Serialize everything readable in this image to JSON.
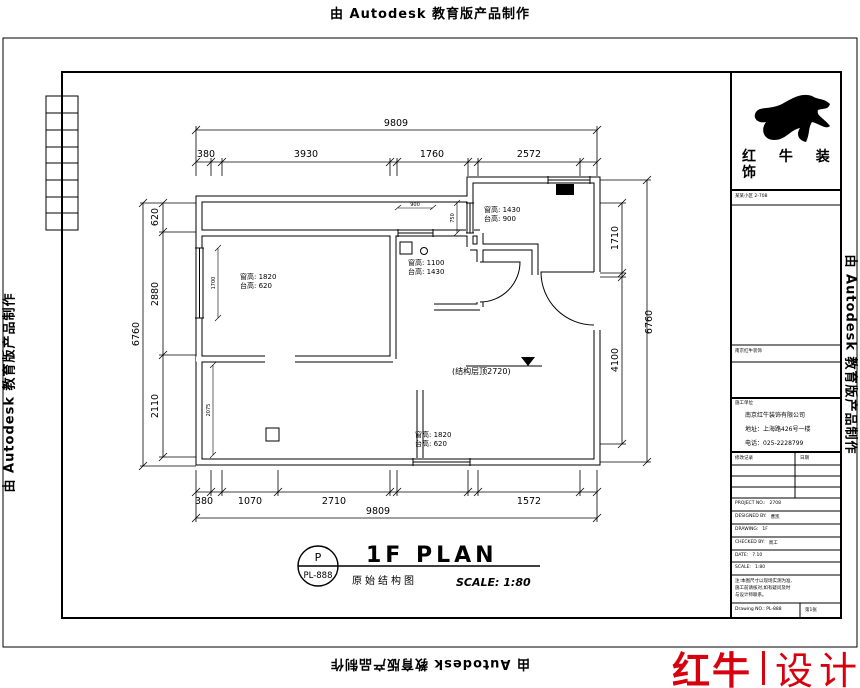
{
  "stamp": {
    "text": "由 Autodesk 教育版产品制作"
  },
  "logo_block": {
    "line1": "红 牛 装",
    "line2": "饰"
  },
  "titleblock": {
    "project_row": "某某小区 2-708",
    "dept_row": "南京红牛装饰",
    "builder_row": "施工单位",
    "company": "南京红牛装饰有限公司",
    "address": "地址：上海路426号一楼",
    "phone": "电话：025-2228799",
    "rev_label": "修改记录",
    "rev_date": "日期",
    "fields": [
      {
        "label": "PROJECT NO.:",
        "value": "2708"
      },
      {
        "label": "DESIGNED BY:",
        "value": "曹凯"
      },
      {
        "label": "DRAWING:",
        "value": "1F"
      },
      {
        "label": "CHECKED BY:",
        "value": "周工"
      },
      {
        "label": "DATE:",
        "value": "7.10"
      },
      {
        "label": "SCALE:",
        "value": "1:80"
      }
    ],
    "notes": [
      "注:本图尺寸以现场实测为准,",
      "施工前请核对,如有疑问及时",
      "与设计师联系。"
    ],
    "drawing_no_label": "Drawing NO.: PL-888",
    "sheet": "第1张"
  },
  "plan": {
    "dims": {
      "top_total": "9809",
      "top_segments": [
        "380",
        "3930",
        "1760",
        "2572"
      ],
      "bottom_segments": [
        "380",
        "1070",
        "2710",
        "1572"
      ],
      "bottom_total": "9809",
      "left_segments": [
        "620",
        "2880",
        "2110"
      ],
      "left_total": "6760",
      "right_segments": [
        "1710",
        "4100"
      ],
      "right_total": "6760",
      "small": [
        "900",
        "750",
        "1700",
        "2075"
      ]
    },
    "annotations": {
      "win_kitchen": {
        "l1": "窗高: 1430",
        "l2": "台高: 900"
      },
      "win_mid": {
        "l1": "窗高: 1100",
        "l2": "台高: 1430"
      },
      "win_left": {
        "l1": "窗高: 1820",
        "l2": "台高: 620"
      },
      "win_bottom": {
        "l1": "窗高: 1820",
        "l2": "台高: 620"
      },
      "ceiling": "(结构层顶2720)"
    },
    "title": {
      "bubble_top": "P",
      "bubble_bottom": "PL-888",
      "name": "1F PLAN",
      "subtitle": "原始结构图",
      "scale": "SCALE: 1:80"
    }
  },
  "footer_logo": {
    "part1": "红牛",
    "part2": "设计"
  }
}
